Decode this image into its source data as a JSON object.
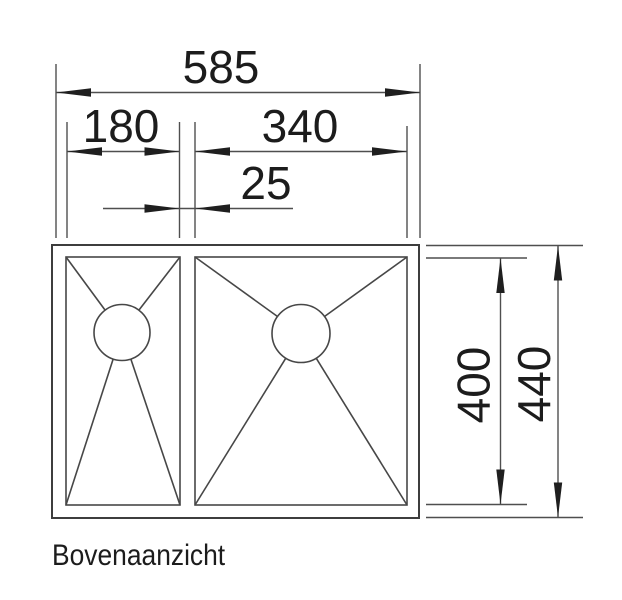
{
  "drawing": {
    "caption": "Bovenaanzicht",
    "dims": {
      "total_width": "585",
      "left_bowl_width": "180",
      "right_bowl_width": "340",
      "gap": "25",
      "inner_depth": "400",
      "total_depth": "440"
    },
    "colors": {
      "line": "#4f4f4f",
      "outline": "#3d3d3d",
      "arrow": "#1f1f1f",
      "text": "#1c1c1c",
      "background": "#ffffff"
    }
  }
}
